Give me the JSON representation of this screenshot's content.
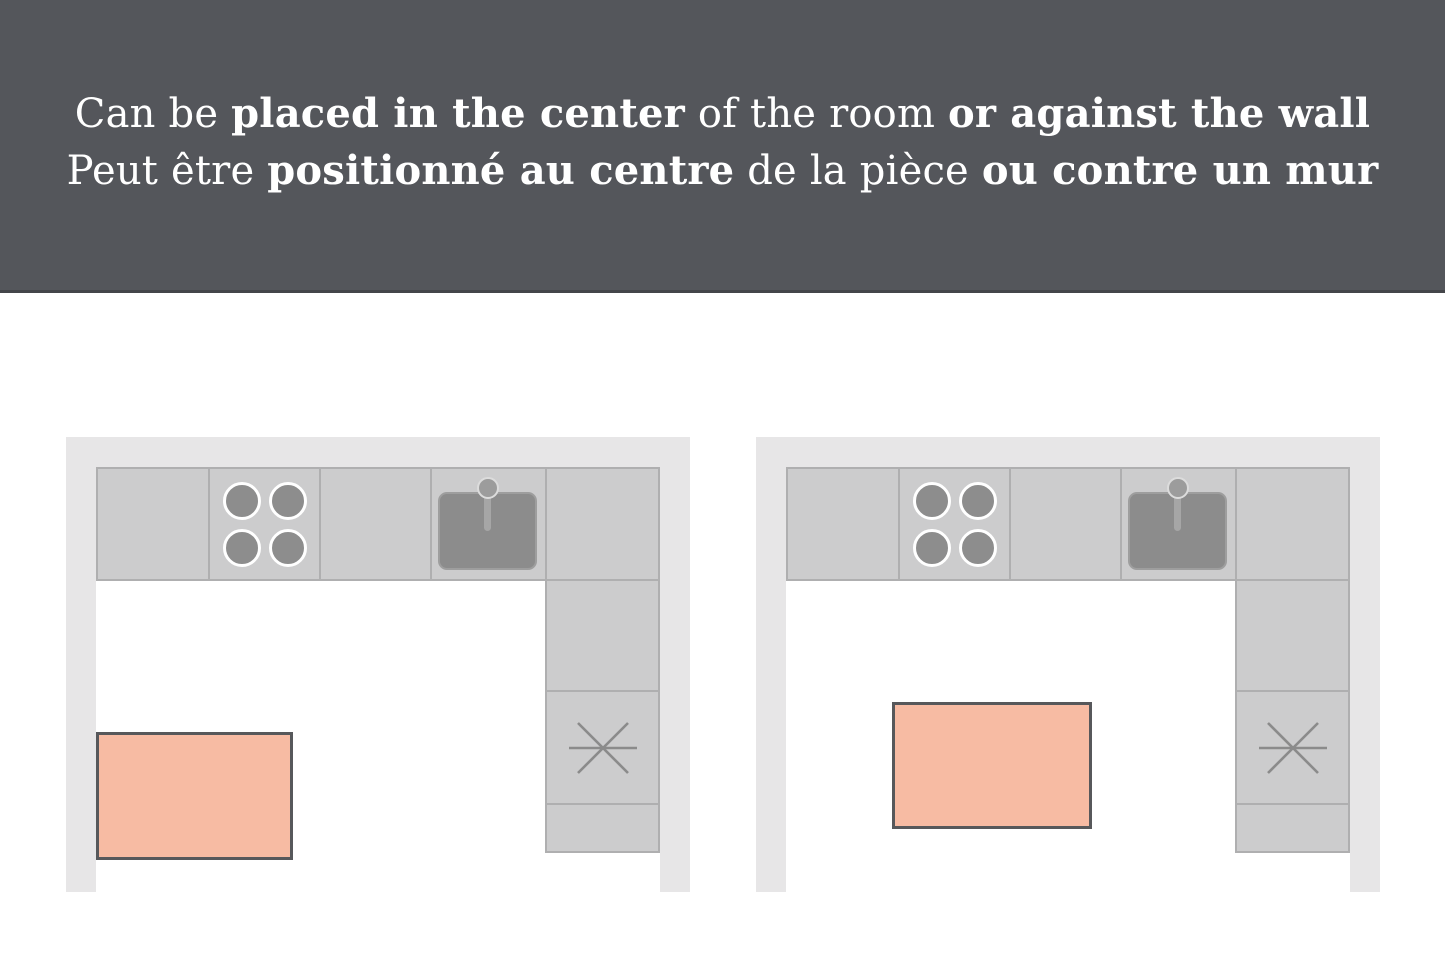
{
  "header": {
    "line1": {
      "seg0": "Can be ",
      "seg1": "placed in the center",
      "seg2": " of the room ",
      "seg3": "or against the wall"
    },
    "line2": {
      "seg0": "Peut être ",
      "seg1": "positionné au centre",
      "seg2": " de la pièce ",
      "seg3": "ou contre un mur"
    }
  },
  "colors": {
    "page_bg": "#FFFFFF",
    "banner": "#54565B",
    "text": "#FFFFFF",
    "wall": "#E7E6E7",
    "cabinet_fill": "#CCCCCD",
    "cabinet_border": "#AFAFB0",
    "burner_fill": "#8D8D8D",
    "burner_ring": "#FFFFFF",
    "sink_fill": "#8C8C8C",
    "sink_outline": "#9E9E9E",
    "faucet_fill": "#9C9C9C",
    "faucet_ring": "#DCDCDC",
    "faucet_stem": "#A6A6A6",
    "asterisk": "#8B8B8B",
    "island_fill": "#F7BBA3",
    "island_border": "#57585B"
  },
  "diagrams": [
    {
      "name": "island-against-wall",
      "island_position": "against-left-wall"
    },
    {
      "name": "island-in-center",
      "island_position": "room-center"
    }
  ],
  "icons": {
    "cooktop": "four-burner-cooktop",
    "sink": "sink-with-faucet",
    "asterisk": "six-spoke-asterisk"
  }
}
